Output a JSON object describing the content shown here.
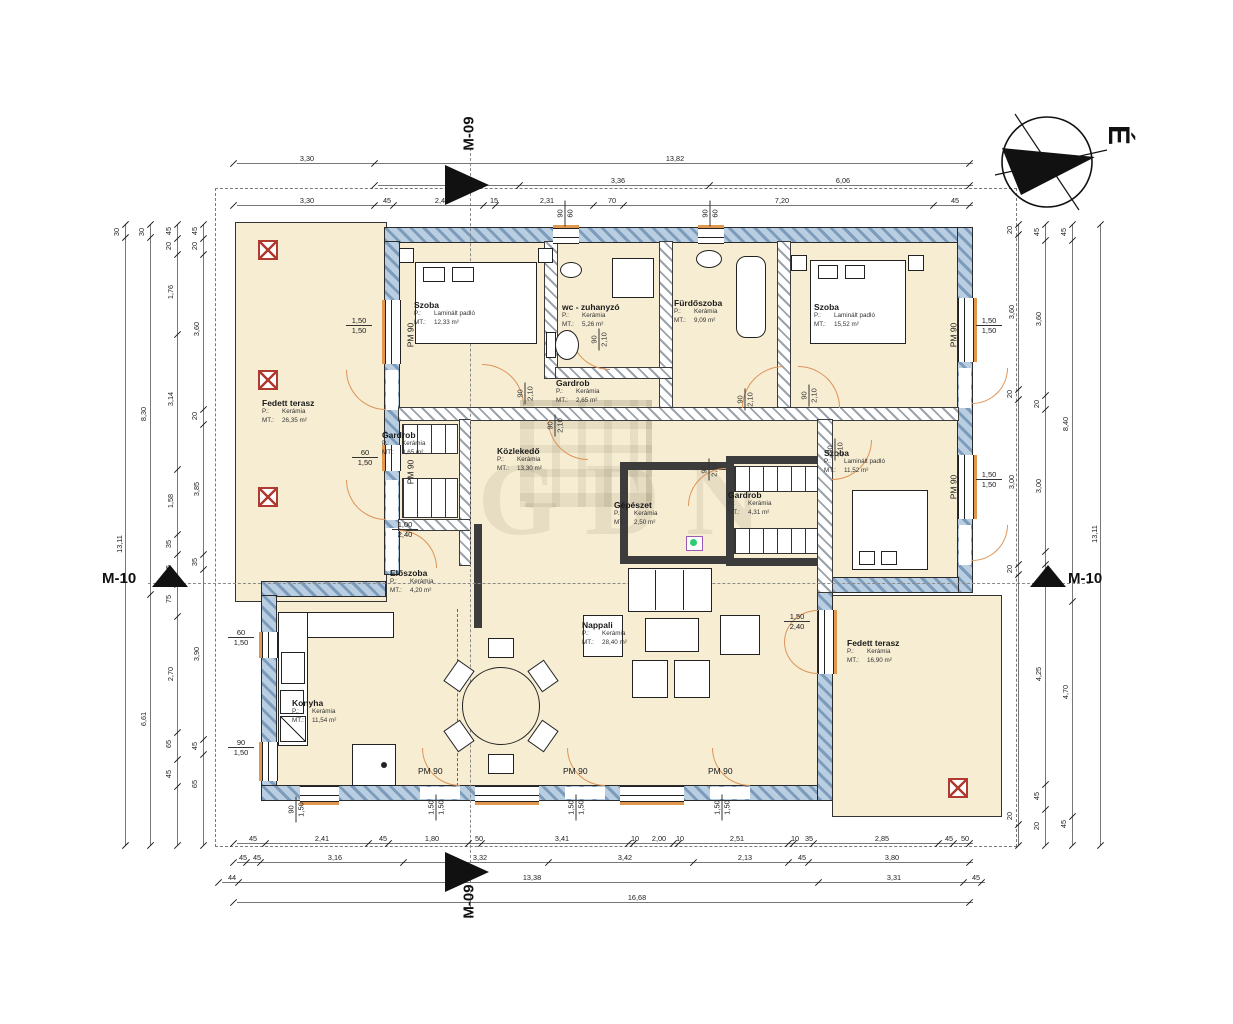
{
  "north_label": "É",
  "watermark": "GDN",
  "markers": {
    "m09": "M-09",
    "m10": "M-10"
  },
  "keys": {
    "floor": "P.:",
    "area": "MT.:"
  },
  "colors": {
    "room_fill": "#f6edd2",
    "ext_wall": "#7d9cbb",
    "door_arc": "#dd9459",
    "column_red": "#b03a30"
  },
  "rooms": [
    {
      "name": "Fedett terasz",
      "floor": "Kerámia",
      "area": "26,35 m²"
    },
    {
      "name": "Szoba",
      "floor": "Laminált padló",
      "area": "12,33 m²"
    },
    {
      "name": "wc - zuhanyzó",
      "floor": "Kerámia",
      "area": "5,26 m²"
    },
    {
      "name": "Fürdőszoba",
      "floor": "Kerámia",
      "area": "9,09 m²"
    },
    {
      "name": "Szoba",
      "floor": "Laminált padló",
      "area": "15,52 m²"
    },
    {
      "name": "Gardrob",
      "floor": "Kerámia",
      "area": "2,65 m²"
    },
    {
      "name": "Gardrob",
      "floor": "Kerámia",
      "area": "3,65 m²"
    },
    {
      "name": "Közlekedő",
      "floor": "Kerámia",
      "area": "13,30 m²"
    },
    {
      "name": "Gépészet",
      "floor": "Kerámia",
      "area": "2,50 m²"
    },
    {
      "name": "Gardrob",
      "floor": "Kerámia",
      "area": "4,31 m²"
    },
    {
      "name": "Szoba",
      "floor": "Laminált padló",
      "area": "11,52 m²"
    },
    {
      "name": "Előszoba",
      "floor": "Kerámia",
      "area": "4,20 m²"
    },
    {
      "name": "Konyha",
      "floor": "Kerámia",
      "area": "11,54 m²"
    },
    {
      "name": "Nappali",
      "floor": "Kerámia",
      "area": "28,40 m²"
    },
    {
      "name": "Fedett terasz",
      "floor": "Kerámia",
      "area": "16,90 m²"
    }
  ],
  "pm_labels": [
    {
      "t": "PM 90",
      "x": 398,
      "y": 330,
      "rot": 1
    },
    {
      "t": "PM 90",
      "x": 398,
      "y": 467,
      "rot": 1
    },
    {
      "t": "PM 90",
      "x": 941,
      "y": 330,
      "rot": 1
    },
    {
      "t": "PM 90",
      "x": 941,
      "y": 482,
      "rot": 1
    },
    {
      "t": "PM 90",
      "x": 418,
      "y": 766,
      "rot": 0
    },
    {
      "t": "PM 90",
      "x": 563,
      "y": 766,
      "rot": 0
    },
    {
      "t": "PM 90",
      "x": 708,
      "y": 766,
      "rot": 0
    }
  ],
  "fracs": [
    {
      "a": "1,50",
      "b": "1,50",
      "x": 346,
      "y": 316,
      "rot": 0,
      "door": 0
    },
    {
      "a": "60",
      "b": "1,50",
      "x": 352,
      "y": 448,
      "rot": 0,
      "door": 0
    },
    {
      "a": "60",
      "b": "1,50",
      "x": 228,
      "y": 628,
      "rot": 0,
      "door": 0
    },
    {
      "a": "90",
      "b": "1,50",
      "x": 228,
      "y": 738,
      "rot": 0,
      "door": 0
    },
    {
      "a": "1,50",
      "b": "1,50",
      "x": 976,
      "y": 316,
      "rot": 0,
      "door": 0
    },
    {
      "a": "1,50",
      "b": "1,50",
      "x": 976,
      "y": 470,
      "rot": 0,
      "door": 0
    },
    {
      "a": "1,50",
      "b": "2,40",
      "x": 784,
      "y": 612,
      "rot": 0,
      "door": 0
    },
    {
      "a": "1,00",
      "b": "2,40",
      "x": 392,
      "y": 520,
      "rot": 0,
      "door": 0
    },
    {
      "a": "90",
      "b": "60",
      "x": 552,
      "y": 204,
      "rot": 1,
      "door": 0
    },
    {
      "a": "90",
      "b": "60",
      "x": 697,
      "y": 204,
      "rot": 1,
      "door": 0
    },
    {
      "a": "90",
      "b": "1,50",
      "x": 283,
      "y": 800,
      "rot": 1,
      "door": 0
    },
    {
      "a": "1,50",
      "b": "1,50",
      "x": 423,
      "y": 798,
      "rot": 1,
      "door": 0
    },
    {
      "a": "1,50",
      "b": "1,50",
      "x": 563,
      "y": 798,
      "rot": 1,
      "door": 0
    },
    {
      "a": "1,50",
      "b": "1,50",
      "x": 709,
      "y": 798,
      "rot": 1,
      "door": 0
    },
    {
      "a": "90",
      "b": "2,10",
      "x": 514,
      "y": 384,
      "rot": 1,
      "door": 1
    },
    {
      "a": "90",
      "b": "2,10",
      "x": 588,
      "y": 330,
      "rot": 1,
      "door": 1
    },
    {
      "a": "90",
      "b": "2,10",
      "x": 734,
      "y": 390,
      "rot": 1,
      "door": 1
    },
    {
      "a": "90",
      "b": "2,10",
      "x": 798,
      "y": 386,
      "rot": 1,
      "door": 1
    },
    {
      "a": "90",
      "b": "2,10",
      "x": 824,
      "y": 440,
      "rot": 1,
      "door": 1
    },
    {
      "a": "90",
      "b": "2,10",
      "x": 544,
      "y": 416,
      "rot": 1,
      "door": 1
    },
    {
      "a": "90",
      "b": "2,10",
      "x": 698,
      "y": 460,
      "rot": 1,
      "door": 1
    }
  ],
  "chains": [
    {
      "dir": "h",
      "x": 237,
      "y": 163,
      "len": 736,
      "ticks": [
        0,
        141,
        736
      ],
      "labels": [
        {
          "t": "3,30",
          "p": 70
        },
        {
          "t": "13,82",
          "p": 438
        }
      ]
    },
    {
      "dir": "h",
      "x": 378,
      "y": 185,
      "len": 595,
      "ticks": [
        0,
        145,
        335,
        595
      ],
      "labels": [
        {
          "t": "3,36",
          "p": 240
        },
        {
          "t": "6,06",
          "p": 465
        }
      ]
    },
    {
      "dir": "h",
      "x": 237,
      "y": 205,
      "len": 736,
      "ticks": [
        0,
        141,
        160,
        250,
        262,
        360,
        390,
        700,
        736
      ],
      "labels": [
        {
          "t": "3,30",
          "p": 70
        },
        {
          "t": "45",
          "p": 150
        },
        {
          "t": "2,45",
          "p": 205
        },
        {
          "t": "15",
          "p": 257
        },
        {
          "t": "2,31",
          "p": 310
        },
        {
          "t": "70",
          "p": 375
        },
        {
          "t": "7,20",
          "p": 545
        },
        {
          "t": "45",
          "p": 718
        }
      ]
    },
    {
      "dir": "h",
      "x": 237,
      "y": 843,
      "len": 736,
      "ticks": [
        0,
        32,
        135,
        155,
        235,
        248,
        395,
        400,
        440,
        445,
        555,
        560,
        580,
        705,
        720,
        736
      ],
      "labels": [
        {
          "t": "45",
          "p": 16
        },
        {
          "t": "2,41",
          "p": 85
        },
        {
          "t": "45",
          "p": 146
        },
        {
          "t": "1,80",
          "p": 195
        },
        {
          "t": "50",
          "p": 242
        },
        {
          "t": "3,41",
          "p": 325
        },
        {
          "t": "10",
          "p": 398
        },
        {
          "t": "2,00",
          "p": 422
        },
        {
          "t": "10",
          "p": 443
        },
        {
          "t": "2,51",
          "p": 500
        },
        {
          "t": "10",
          "p": 558
        },
        {
          "t": "35",
          "p": 572
        },
        {
          "t": "2,85",
          "p": 645
        },
        {
          "t": "45",
          "p": 712
        },
        {
          "t": "50",
          "p": 728
        }
      ]
    },
    {
      "dir": "h",
      "x": 237,
      "y": 862,
      "len": 736,
      "ticks": [
        0,
        13,
        27,
        170,
        315,
        460,
        555,
        575,
        736
      ],
      "labels": [
        {
          "t": "45",
          "p": 6
        },
        {
          "t": "45",
          "p": 20
        },
        {
          "t": "3,16",
          "p": 98
        },
        {
          "t": "3,32",
          "p": 243
        },
        {
          "t": "3,42",
          "p": 388
        },
        {
          "t": "2,13",
          "p": 508
        },
        {
          "t": "45",
          "p": 565
        },
        {
          "t": "3,80",
          "p": 655
        }
      ]
    },
    {
      "dir": "h",
      "x": 222,
      "y": 882,
      "len": 763,
      "ticks": [
        0,
        20,
        600,
        745,
        763
      ],
      "labels": [
        {
          "t": "44",
          "p": 10
        },
        {
          "t": "13,38",
          "p": 310
        },
        {
          "t": "3,31",
          "p": 672
        },
        {
          "t": "45",
          "p": 754
        }
      ]
    },
    {
      "dir": "h",
      "x": 237,
      "y": 902,
      "len": 736,
      "ticks": [
        0,
        736
      ],
      "labels": [
        {
          "t": "16,68",
          "p": 400
        }
      ]
    },
    {
      "dir": "v",
      "x": 125,
      "y": 224,
      "len": 621,
      "ticks": [
        0,
        13,
        621
      ],
      "labels": [
        {
          "t": "30",
          "p": 8
        },
        {
          "t": "13,11",
          "p": 320
        }
      ]
    },
    {
      "dir": "v",
      "x": 150,
      "y": 224,
      "len": 621,
      "ticks": [
        0,
        13,
        370,
        621
      ],
      "labels": [
        {
          "t": "30",
          "p": 8
        },
        {
          "t": "8,30",
          "p": 190
        },
        {
          "t": "6,61",
          "p": 495
        }
      ]
    },
    {
      "dir": "v",
      "x": 177,
      "y": 224,
      "len": 621,
      "ticks": [
        0,
        14,
        30,
        110,
        245,
        310,
        330,
        360,
        392,
        508,
        535,
        562,
        621
      ],
      "labels": [
        {
          "t": "45",
          "p": 7
        },
        {
          "t": "20",
          "p": 22
        },
        {
          "t": "1,76",
          "p": 68
        },
        {
          "t": "3,14",
          "p": 175
        },
        {
          "t": "1,58",
          "p": 277
        },
        {
          "t": "35",
          "p": 320
        },
        {
          "t": "65",
          "p": 345
        },
        {
          "t": "75",
          "p": 375
        },
        {
          "t": "2,70",
          "p": 450
        },
        {
          "t": "65",
          "p": 520
        },
        {
          "t": "45",
          "p": 550
        }
      ]
    },
    {
      "dir": "v",
      "x": 203,
      "y": 224,
      "len": 621,
      "ticks": [
        0,
        14,
        30,
        185,
        200,
        330,
        345,
        515,
        530,
        621
      ],
      "labels": [
        {
          "t": "45",
          "p": 7
        },
        {
          "t": "20",
          "p": 22
        },
        {
          "t": "3,60",
          "p": 105
        },
        {
          "t": "20",
          "p": 192
        },
        {
          "t": "3,85",
          "p": 265
        },
        {
          "t": "35",
          "p": 338
        },
        {
          "t": "3,90",
          "p": 430
        },
        {
          "t": "45",
          "p": 522
        },
        {
          "t": "65",
          "p": 560
        }
      ]
    },
    {
      "dir": "v",
      "x": 1018,
      "y": 224,
      "len": 621,
      "ticks": [
        0,
        10,
        165,
        175,
        340,
        350,
        600,
        621
      ],
      "labels": [
        {
          "t": "20",
          "p": 6
        },
        {
          "t": "3,60",
          "p": 88
        },
        {
          "t": "20",
          "p": 170
        },
        {
          "t": "3,00",
          "p": 258
        },
        {
          "t": "20",
          "p": 345
        },
        {
          "t": "20",
          "p": 592
        }
      ]
    },
    {
      "dir": "v",
      "x": 1045,
      "y": 224,
      "len": 621,
      "ticks": [
        0,
        16,
        171,
        185,
        327,
        340,
        560,
        585,
        621
      ],
      "labels": [
        {
          "t": "45",
          "p": 8
        },
        {
          "t": "3,60",
          "p": 95
        },
        {
          "t": "20",
          "p": 180
        },
        {
          "t": "3,00",
          "p": 262
        },
        {
          "t": "4,25",
          "p": 450
        },
        {
          "t": "45",
          "p": 572
        },
        {
          "t": "20",
          "p": 602
        }
      ]
    },
    {
      "dir": "v",
      "x": 1072,
      "y": 224,
      "len": 621,
      "ticks": [
        0,
        16,
        377,
        592,
        621
      ],
      "labels": [
        {
          "t": "45",
          "p": 8
        },
        {
          "t": "8,40",
          "p": 200
        },
        {
          "t": "4,70",
          "p": 468
        },
        {
          "t": "45",
          "p": 600
        }
      ]
    },
    {
      "dir": "v",
      "x": 1100,
      "y": 224,
      "len": 621,
      "ticks": [
        0,
        621
      ],
      "labels": [
        {
          "t": "13,11",
          "p": 310
        }
      ]
    }
  ]
}
